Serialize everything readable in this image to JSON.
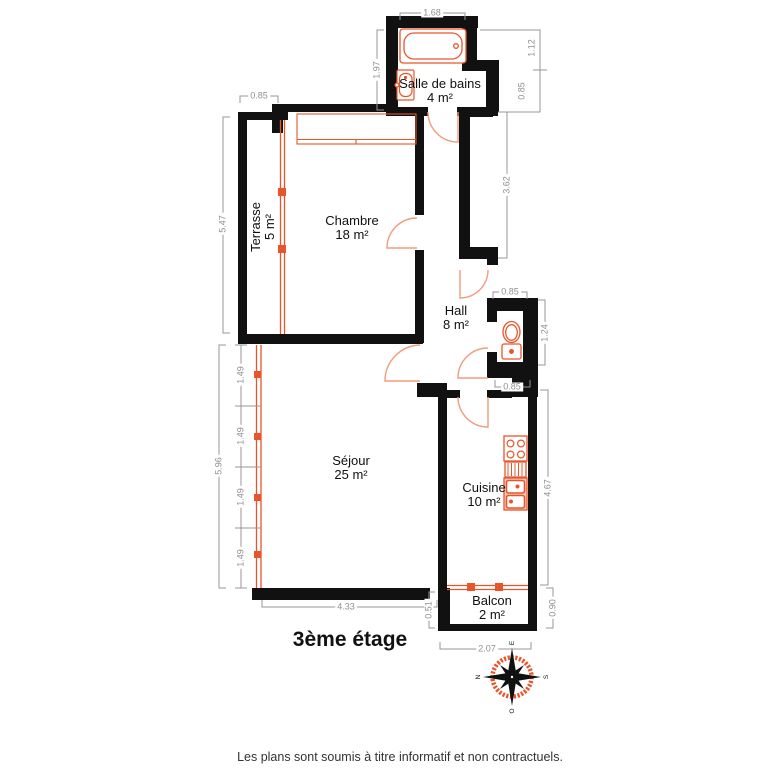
{
  "title": "3ème étage",
  "footer": "Les plans sont soumis à titre informatif et non contractuels.",
  "rooms": {
    "bathroom": {
      "name": "Salle de bains",
      "area": "4 m²"
    },
    "bedroom": {
      "name": "Chambre",
      "area": "18 m²"
    },
    "terrace": {
      "name": "Terrasse",
      "area": "5 m²"
    },
    "hall": {
      "name": "Hall",
      "area": "8 m²"
    },
    "living": {
      "name": "Séjour",
      "area": "25 m²"
    },
    "kitchen": {
      "name": "Cuisine",
      "area": "10 m²"
    },
    "balcony": {
      "name": "Balcon",
      "area": "2 m²"
    }
  },
  "dimensions": {
    "bath_top": "1.68",
    "bath_left": "1.97",
    "bath_right_upper": "1.12",
    "bath_right_lower": "0.85",
    "duct_right": "3.62",
    "terrace_top": "0.85",
    "terrace_left": "5.47",
    "wc_top": "0.85",
    "wc_right": "1.24",
    "wc_bottom": "0.85",
    "living_left_total": "5.96",
    "living_left_seg1": "1.49",
    "living_left_seg2": "1.49",
    "living_left_seg3": "1.49",
    "living_left_seg4": "1.49",
    "living_bottom": "4.33",
    "kitchen_right": "4.67",
    "balcony_left": "0.51",
    "balcony_right": "0.90",
    "balcony_bottom": "2.07"
  },
  "compass": {
    "north": "N",
    "east": "E",
    "south": "S",
    "west": "O"
  },
  "colors": {
    "wall": "#111111",
    "fixture": "#e9552b",
    "door_arc": "#f29b7d",
    "dimension": "#979797",
    "text": "#1a1a1a"
  }
}
